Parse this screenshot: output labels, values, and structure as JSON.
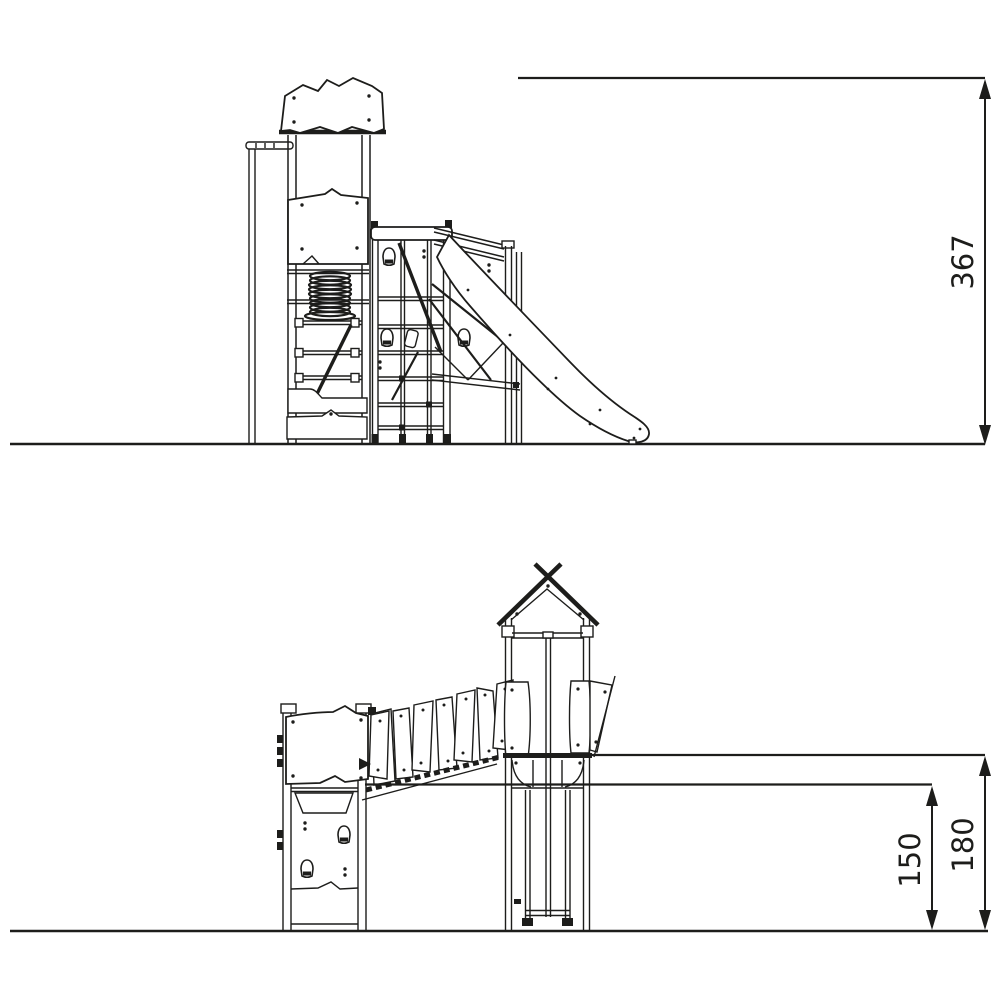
{
  "drawing": {
    "background_color": "#ffffff",
    "line_color": "#1d1d1b",
    "views": {
      "side_elevation": {
        "position": "top"
      },
      "front_elevation": {
        "position": "bottom"
      }
    },
    "dimensions": {
      "total_height": "367",
      "upper_level_height": "180",
      "lower_level_height": "150"
    }
  }
}
